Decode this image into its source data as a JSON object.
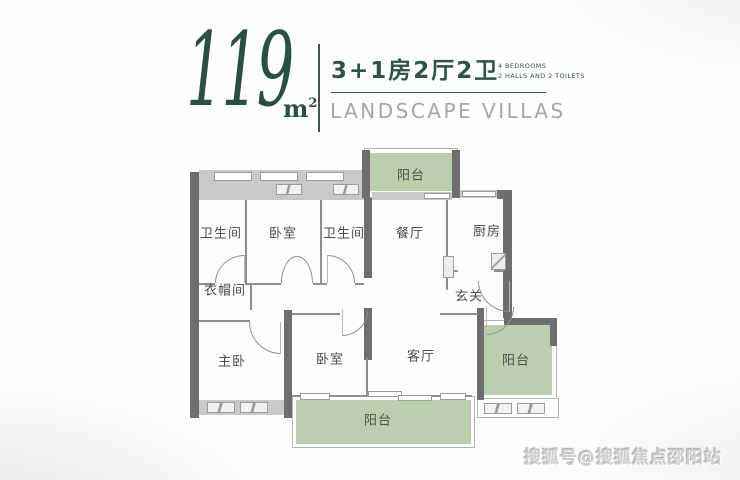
{
  "header": {
    "area_value": "119",
    "area_unit": "m",
    "area_sup": "2",
    "type_cn": "3+1房2厅2卫",
    "type_en_line1": "4 BEDROOMS",
    "type_en_line2": "2 HALLS AND 2 TOILETS",
    "tagline": "LANDSCAPE VILLAS"
  },
  "floorplan": {
    "labels": {
      "bath1": "卫生间",
      "bedroom_top": "卧室",
      "bath2": "卫生间",
      "dining": "餐厅",
      "kitchen": "厨房",
      "cloakroom": "衣帽间",
      "foyer": "玄关",
      "master": "主卧",
      "bedroom_bottom": "卧室",
      "living": "客厅",
      "balcony_top": "阳台",
      "balcony_right": "阳台",
      "balcony_bottom": "阳台"
    }
  },
  "watermark": "搜狐号@搜狐焦点邵阳站",
  "colors": {
    "accent_green": "#2a5044",
    "balcony_green": "#b9cfae",
    "wall_gray": "#6e6e6e",
    "tagline_gray": "#9fa9a6"
  }
}
